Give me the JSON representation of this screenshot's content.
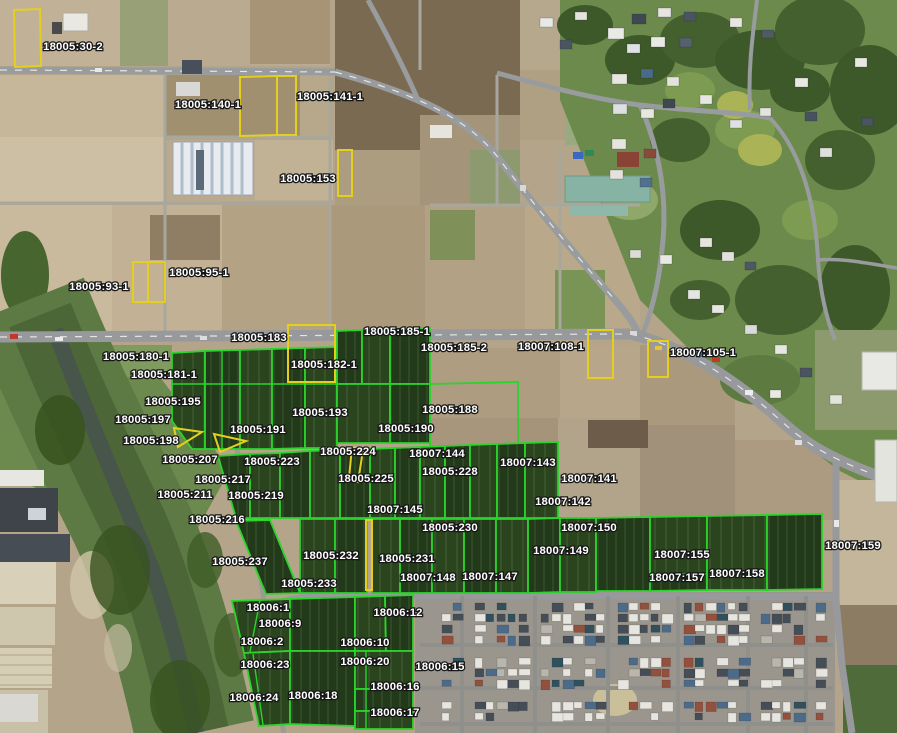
{
  "map": {
    "type": "aerial-cadastral-parcel-viewer",
    "colors": {
      "parcel_outline_green": "#2bd32b",
      "parcel_outline_yellow": "#e5cf1e",
      "label_fill": "#ffffff",
      "label_outline": "#161616"
    },
    "labels": [
      {
        "text": "18005:30-2",
        "x": 73,
        "y": 47
      },
      {
        "text": "18005:140-1",
        "x": 208,
        "y": 105
      },
      {
        "text": "18005:141-1",
        "x": 330,
        "y": 97
      },
      {
        "text": "18005:153",
        "x": 308,
        "y": 179
      },
      {
        "text": "18005:93-1",
        "x": 99,
        "y": 287
      },
      {
        "text": "18005:95-1",
        "x": 199,
        "y": 273
      },
      {
        "text": "18005:180-1",
        "x": 136,
        "y": 357
      },
      {
        "text": "18005:181-1",
        "x": 164,
        "y": 375
      },
      {
        "text": "18005:183",
        "x": 259,
        "y": 338
      },
      {
        "text": "18005:185-1",
        "x": 397,
        "y": 332
      },
      {
        "text": "18005:182-1",
        "x": 324,
        "y": 365
      },
      {
        "text": "18005:185-2",
        "x": 454,
        "y": 348
      },
      {
        "text": "18007:108-1",
        "x": 551,
        "y": 347
      },
      {
        "text": "18007:105-1",
        "x": 703,
        "y": 353
      },
      {
        "text": "18005:195",
        "x": 173,
        "y": 402
      },
      {
        "text": "18005:197",
        "x": 143,
        "y": 420
      },
      {
        "text": "18005:198",
        "x": 151,
        "y": 441
      },
      {
        "text": "18005:193",
        "x": 320,
        "y": 413
      },
      {
        "text": "18005:191",
        "x": 258,
        "y": 430
      },
      {
        "text": "18005:190",
        "x": 406,
        "y": 429
      },
      {
        "text": "18005:188",
        "x": 450,
        "y": 410
      },
      {
        "text": "18005:207",
        "x": 190,
        "y": 460
      },
      {
        "text": "18005:223",
        "x": 272,
        "y": 462
      },
      {
        "text": "18005:224",
        "x": 348,
        "y": 452
      },
      {
        "text": "18005:217",
        "x": 223,
        "y": 480
      },
      {
        "text": "18005:225",
        "x": 366,
        "y": 479
      },
      {
        "text": "18005:211",
        "x": 185,
        "y": 495
      },
      {
        "text": "18005:219",
        "x": 256,
        "y": 496
      },
      {
        "text": "18005:216",
        "x": 217,
        "y": 520
      },
      {
        "text": "18005:228",
        "x": 450,
        "y": 472
      },
      {
        "text": "18007:144",
        "x": 437,
        "y": 454
      },
      {
        "text": "18007:143",
        "x": 528,
        "y": 463
      },
      {
        "text": "18007:141",
        "x": 589,
        "y": 479
      },
      {
        "text": "18007:142",
        "x": 563,
        "y": 502
      },
      {
        "text": "18007:145",
        "x": 395,
        "y": 510
      },
      {
        "text": "18005:230",
        "x": 450,
        "y": 528
      },
      {
        "text": "18007:150",
        "x": 589,
        "y": 528
      },
      {
        "text": "18007:149",
        "x": 561,
        "y": 551
      },
      {
        "text": "18005:232",
        "x": 331,
        "y": 556
      },
      {
        "text": "18005:231",
        "x": 407,
        "y": 559
      },
      {
        "text": "18005:237",
        "x": 240,
        "y": 562
      },
      {
        "text": "18005:233",
        "x": 309,
        "y": 584
      },
      {
        "text": "18007:148",
        "x": 428,
        "y": 578
      },
      {
        "text": "18007:147",
        "x": 490,
        "y": 577
      },
      {
        "text": "18007:155",
        "x": 682,
        "y": 555
      },
      {
        "text": "18007:157",
        "x": 677,
        "y": 578
      },
      {
        "text": "18007:158",
        "x": 737,
        "y": 574
      },
      {
        "text": "18007:159",
        "x": 853,
        "y": 546
      },
      {
        "text": "18006:1",
        "x": 268,
        "y": 608
      },
      {
        "text": "18006:9",
        "x": 280,
        "y": 624
      },
      {
        "text": "18006:2",
        "x": 262,
        "y": 642
      },
      {
        "text": "18006:12",
        "x": 398,
        "y": 613
      },
      {
        "text": "18006:10",
        "x": 365,
        "y": 643
      },
      {
        "text": "18006:23",
        "x": 265,
        "y": 665
      },
      {
        "text": "18006:20",
        "x": 365,
        "y": 662
      },
      {
        "text": "18006:15",
        "x": 440,
        "y": 667
      },
      {
        "text": "18006:16",
        "x": 395,
        "y": 687
      },
      {
        "text": "18006:24",
        "x": 254,
        "y": 698
      },
      {
        "text": "18006:18",
        "x": 313,
        "y": 696
      },
      {
        "text": "18006:17",
        "x": 395,
        "y": 713
      }
    ],
    "parcels": {
      "green": [
        {
          "pts": "172,353 205,351 205,449 192,449 172,421"
        },
        {
          "pts": "205,351 240,350 240,449 205,449"
        },
        {
          "pts": "240,350 272,349 272,449 240,449"
        },
        {
          "pts": "272,349 305,348 305,448 272,449"
        },
        {
          "pts": "305,348 337,347 337,448 305,448"
        },
        {
          "pts": "337,331 362,330 362,384 337,384"
        },
        {
          "pts": "362,330 390,329 390,384 362,384"
        },
        {
          "pts": "390,329 430,328 430,384 390,384"
        },
        {
          "pts": "337,384 390,384 390,443 337,443"
        },
        {
          "pts": "390,384 430,384 430,443 390,443"
        },
        {
          "pts": "430,384 518,382 518,454 430,455",
          "fill": "bare"
        },
        {
          "pts": "218,456 250,454 250,518 236,518"
        },
        {
          "pts": "250,454 280,453 280,518 250,518"
        },
        {
          "pts": "280,453 310,451 310,518 280,518"
        },
        {
          "pts": "310,451 340,450 340,518 310,518"
        },
        {
          "pts": "340,450 370,449 370,518 340,518"
        },
        {
          "pts": "370,449 395,448 395,518 370,518"
        },
        {
          "pts": "395,448 420,447 420,518 395,518"
        },
        {
          "pts": "420,447 445,446 445,518 420,518"
        },
        {
          "pts": "445,446 470,445 470,518 445,518"
        },
        {
          "pts": "470,445 497,444 497,518 470,518"
        },
        {
          "pts": "497,444 525,443 525,518 497,518"
        },
        {
          "pts": "525,443 558,442 558,518 525,518"
        },
        {
          "pts": "236,521 270,520 300,593 266,594"
        },
        {
          "pts": "300,519 335,519 335,593 300,593"
        },
        {
          "pts": "335,519 367,519 367,593 335,593"
        },
        {
          "pts": "372,519 400,519 400,593 372,593"
        },
        {
          "pts": "400,519 432,519 432,593 400,593"
        },
        {
          "pts": "432,519 464,519 464,593 432,593"
        },
        {
          "pts": "464,519 496,519 496,593 464,593"
        },
        {
          "pts": "496,519 528,519 528,593 496,593"
        },
        {
          "pts": "528,519 560,518 560,592 528,593"
        },
        {
          "pts": "560,518 596,518 596,592 560,592"
        },
        {
          "pts": "596,518 650,517 650,591 596,591"
        },
        {
          "pts": "650,517 707,516 707,574 650,575"
        },
        {
          "pts": "650,575 707,574 707,590 650,591"
        },
        {
          "pts": "707,516 767,515 767,590 707,590"
        },
        {
          "pts": "767,515 822,514 822,589 767,590"
        },
        {
          "pts": "232,601 290,599 290,651 244,653"
        },
        {
          "pts": "290,599 355,597 355,651 290,651"
        },
        {
          "pts": "355,597 385,596 386,651 355,651"
        },
        {
          "pts": "385,596 413,595 413,651 386,651"
        },
        {
          "pts": "244,653 290,651 290,724 259,726"
        },
        {
          "pts": "290,651 355,651 355,726 290,724"
        },
        {
          "pts": "355,651 413,651 413,689 355,689"
        },
        {
          "pts": "355,689 413,689 413,711 355,711"
        },
        {
          "pts": "355,711 413,711 413,729 355,729"
        }
      ],
      "green_lines": [
        [
          172,
          384,
          337,
          384
        ],
        [
          260,
          600,
          250,
          652
        ],
        [
          253,
          654,
          263,
          725
        ],
        [
          366,
          651,
          366,
          729
        ],
        [
          222,
          351,
          222,
          449
        ]
      ],
      "yellow": [
        {
          "pts": "14,10 40,9 41,66 15,67"
        },
        {
          "pts": "240,77 277,76 277,135 240,136"
        },
        {
          "pts": "277,76 296,76 296,135 277,135"
        },
        {
          "pts": "338,150 352,150 352,196 338,196"
        },
        {
          "pts": "133,262 148,262 148,302 133,302"
        },
        {
          "pts": "148,262 165,262 165,302 148,302"
        },
        {
          "pts": "288,325 335,325 335,382 288,382"
        },
        {
          "pts": "588,330 613,330 613,378 588,378"
        },
        {
          "pts": "648,341 668,341 668,377 648,377"
        },
        {
          "pts": "174,428 202,432 178,447"
        },
        {
          "pts": "214,434 246,441 220,452"
        },
        {
          "pts": "352,447 363,450 358,482 349,478"
        },
        {
          "pts": "366,520 372,520 372,590 366,590"
        }
      ]
    }
  }
}
